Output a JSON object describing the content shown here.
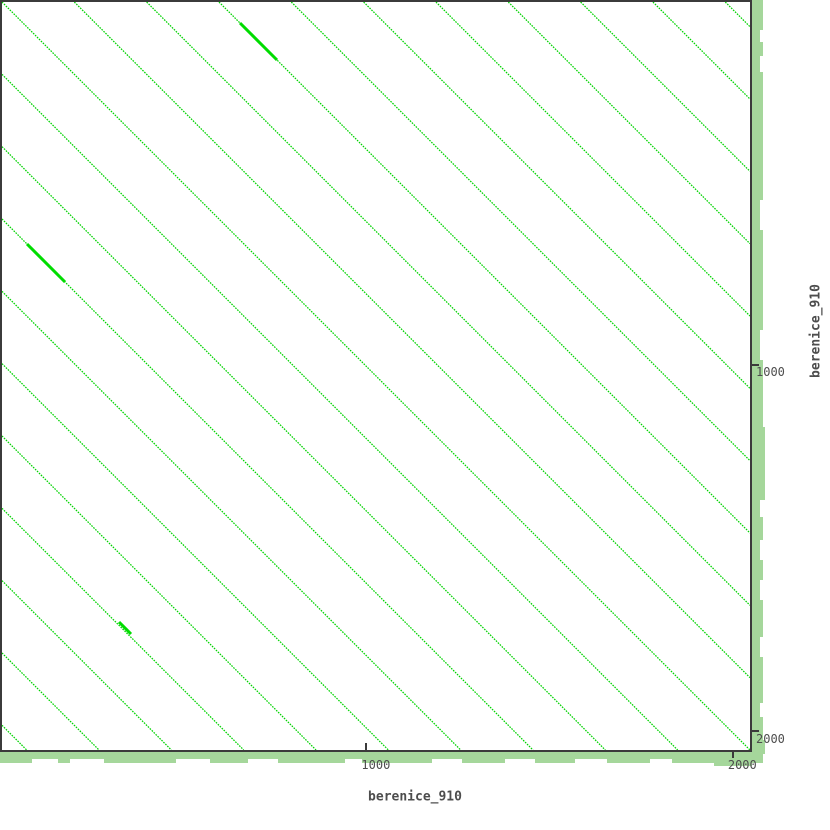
{
  "colors": {
    "background": "#ffffff",
    "frame": "#3b3b3b",
    "sequence_bar": "#a5d79b",
    "diagonal_line": "#00d300",
    "diagonal_bold": "#00dc00",
    "text": "#4d4d4d"
  },
  "axes": {
    "x": {
      "label": "berenice_910",
      "ticks": [
        {
          "value": 1000,
          "label": "1000"
        },
        {
          "value": 2000,
          "label": "2000"
        }
      ]
    },
    "y": {
      "label": "berenice_910",
      "ticks": [
        {
          "value": 1000,
          "label": "1000"
        },
        {
          "value": 2000,
          "label": "2000"
        }
      ]
    }
  },
  "chart_data": {
    "type": "line",
    "subtype": "self-alignment-dotplot",
    "title": "",
    "xlabel": "berenice_910",
    "ylabel": "berenice_910",
    "xlim": [
      0,
      2041
    ],
    "ylim": [
      0,
      2041
    ],
    "x_ticks": [
      1000,
      2000
    ],
    "y_ticks": [
      1000,
      2000
    ],
    "grid": false,
    "legend": "none",
    "plot_px": 748,
    "units_per_px": 2.729,
    "diagonals": {
      "k_min": -10,
      "k_max": 10,
      "spacing_px": 72.33,
      "spacing_units": 197,
      "orientation": "top-left-to-bottom-right"
    },
    "bold_segments_px": [
      [
        238,
        21,
        275,
        58
      ],
      [
        25,
        242,
        63,
        280
      ],
      [
        117,
        620,
        129,
        632
      ]
    ]
  }
}
